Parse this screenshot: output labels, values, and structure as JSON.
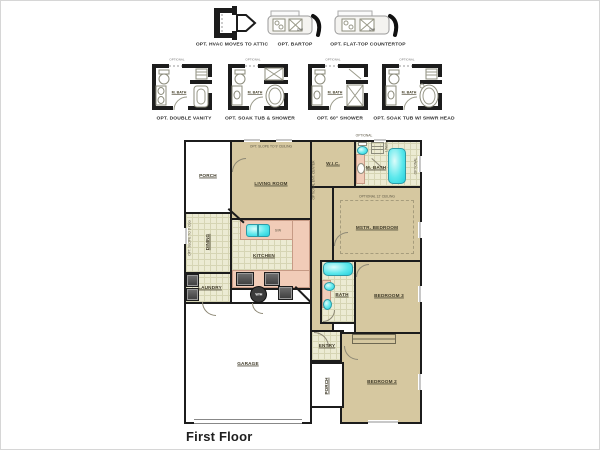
{
  "title": {
    "label": "First Floor"
  },
  "options_row1": {
    "hvac": {
      "label": "OPT. HVAC MOVES TO ATTIC"
    },
    "bartop": {
      "label": "OPT. BARTOP",
      "dw": "D/W"
    },
    "flattop": {
      "label": "OPT. FLAT-TOP COUNTERTOP",
      "dw": "D/W"
    }
  },
  "options_row2": {
    "optional_tag": "OPTIONAL",
    "mbath_label": "M. BATH",
    "cards": [
      {
        "label": "OPT. DOUBLE VANITY"
      },
      {
        "label": "OPT. SOAK TUB & SHOWER"
      },
      {
        "label": "OPT. 60\" SHOWER"
      },
      {
        "label": "OPT. SOAK TUB W/ SHWR HEAD"
      }
    ]
  },
  "floor_plan": {
    "rooms": {
      "porch_top": "PORCH",
      "living_room": "LIVING ROOM",
      "wic": "W.I.C.",
      "master_bath": "M. BATH",
      "master_bedroom": "MSTR. BEDROOM",
      "dining": "DINING",
      "kitchen": "KITCHEN",
      "laundry": "LAUNDRY",
      "garage": "GARAGE",
      "entry": "ENTRY",
      "porch_bottom": "PORCH",
      "bath": "BATH",
      "bedroom3": "BEDROOM 3",
      "bedroom2": "BEDROOM 2"
    },
    "annotations": {
      "slope_ceiling": "OPT. SLOPE TO 9' CEILING",
      "slope_clg": "OPT. SLOPE TO 9' CLG",
      "opt_ceiling": "OPTIONAL 12' CEILING",
      "ent_center": "OPTIONAL ENT. CENTER",
      "linen": "LINEN",
      "optional": "OPTIONAL",
      "water_heater": "W/H",
      "sink_window": "S/W"
    }
  },
  "colors": {
    "wall": "#1c1c1c",
    "room_tan": "#d6c8a0",
    "tile": "#ecebd3",
    "counter_pink": "#f1ccb8",
    "fixture_teal": "#35dde4",
    "appliance_dark": "#4a4a4a"
  }
}
